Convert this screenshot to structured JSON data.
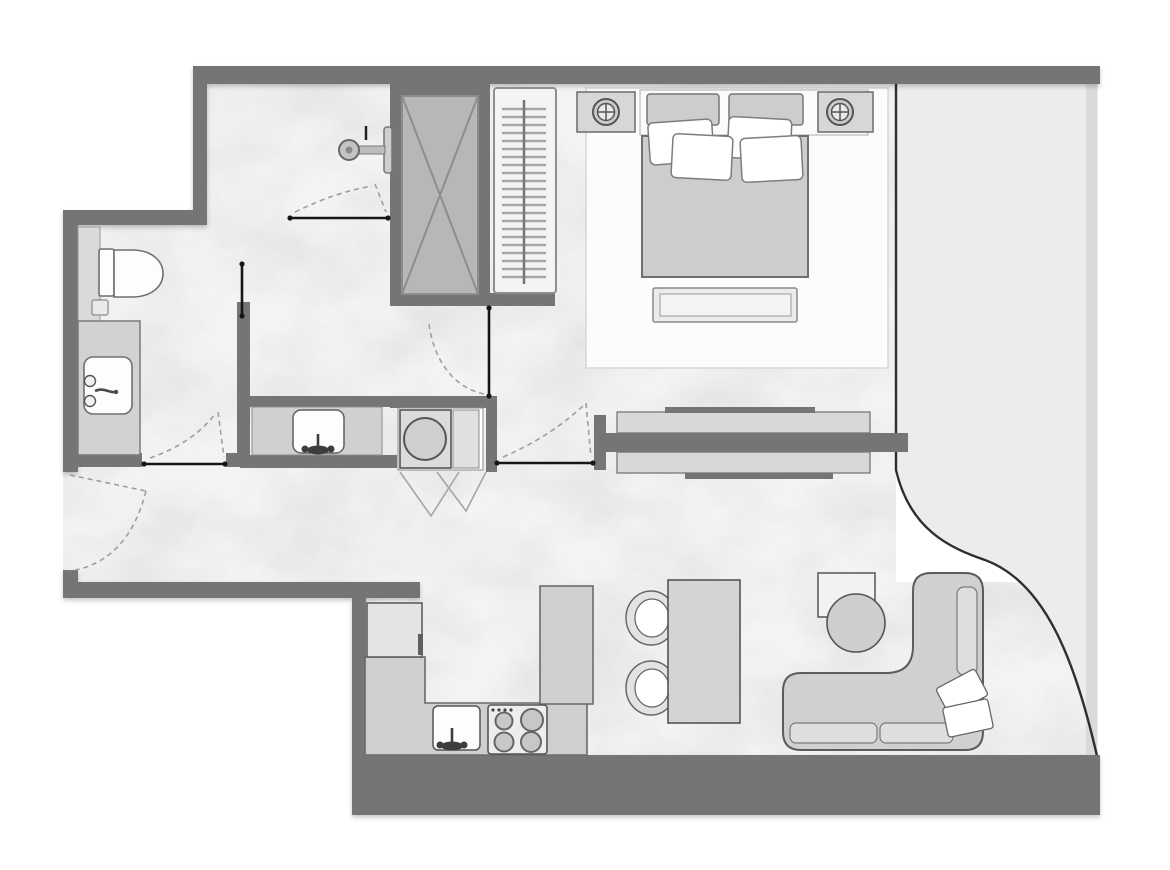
{
  "floor_plan": {
    "background": "#ffffff",
    "colors": {
      "wall": "#757575",
      "floor": "#f3f3f3",
      "balcony": "#ececec",
      "balcony_edge": "#dadada",
      "furniture_fill": "#d2d2d2",
      "furniture_light": "#e4e4e4",
      "white_fixture": "#fdfdfd",
      "outline": "#5f5f5f",
      "glass": "#2e2e2e",
      "door_leaf": "#161616",
      "door_swing": "#9e9e9e",
      "shaft_fill": "#b7b7b7",
      "shaft_line": "#8d8d8d",
      "rug": "#fcfcfc",
      "rug_edge": "#d8d8d8"
    },
    "rooms": [
      {
        "id": "bedroom"
      },
      {
        "id": "shower-room"
      },
      {
        "id": "bathroom"
      },
      {
        "id": "laundry-nook"
      },
      {
        "id": "hallway"
      },
      {
        "id": "kitchen"
      },
      {
        "id": "dining-area"
      },
      {
        "id": "living-area"
      },
      {
        "id": "balcony"
      },
      {
        "id": "service-shaft"
      }
    ],
    "items": [
      {
        "id": "double-bed",
        "room": "bedroom",
        "pillows": 4,
        "headboard_cushions": 2
      },
      {
        "id": "nightstand-with-lamp-left",
        "room": "bedroom"
      },
      {
        "id": "nightstand-with-lamp-right",
        "room": "bedroom"
      },
      {
        "id": "foot-bench",
        "room": "bedroom"
      },
      {
        "id": "area-rug",
        "room": "bedroom"
      },
      {
        "id": "wardrobe-with-hangers",
        "room": "bedroom"
      },
      {
        "id": "tv-partition-with-cabinets",
        "room": "bedroom"
      },
      {
        "id": "shower-head",
        "room": "shower-room"
      },
      {
        "id": "toilet",
        "room": "bathroom"
      },
      {
        "id": "vanity-sink",
        "room": "bathroom"
      },
      {
        "id": "laundry-counter-sink",
        "room": "laundry-nook"
      },
      {
        "id": "washing-machine",
        "room": "laundry-nook"
      },
      {
        "id": "bifold-door",
        "room": "laundry-nook"
      },
      {
        "id": "fridge",
        "room": "kitchen"
      },
      {
        "id": "kitchen-counter",
        "room": "kitchen"
      },
      {
        "id": "kitchen-sink",
        "room": "kitchen"
      },
      {
        "id": "hob-4-burners",
        "room": "kitchen",
        "burners": 4
      },
      {
        "id": "tall-cabinet",
        "room": "kitchen"
      },
      {
        "id": "dining-table",
        "room": "dining-area",
        "chairs": 2
      },
      {
        "id": "side-table",
        "room": "living-area"
      },
      {
        "id": "round-pouf",
        "room": "living-area"
      },
      {
        "id": "l-shaped-sofa",
        "room": "living-area",
        "throw_pillows": 2
      },
      {
        "id": "curved-glass-wall",
        "room": "balcony"
      },
      {
        "id": "entry-door-swing",
        "room": "hallway"
      },
      {
        "id": "doors",
        "count": 5
      }
    ]
  }
}
